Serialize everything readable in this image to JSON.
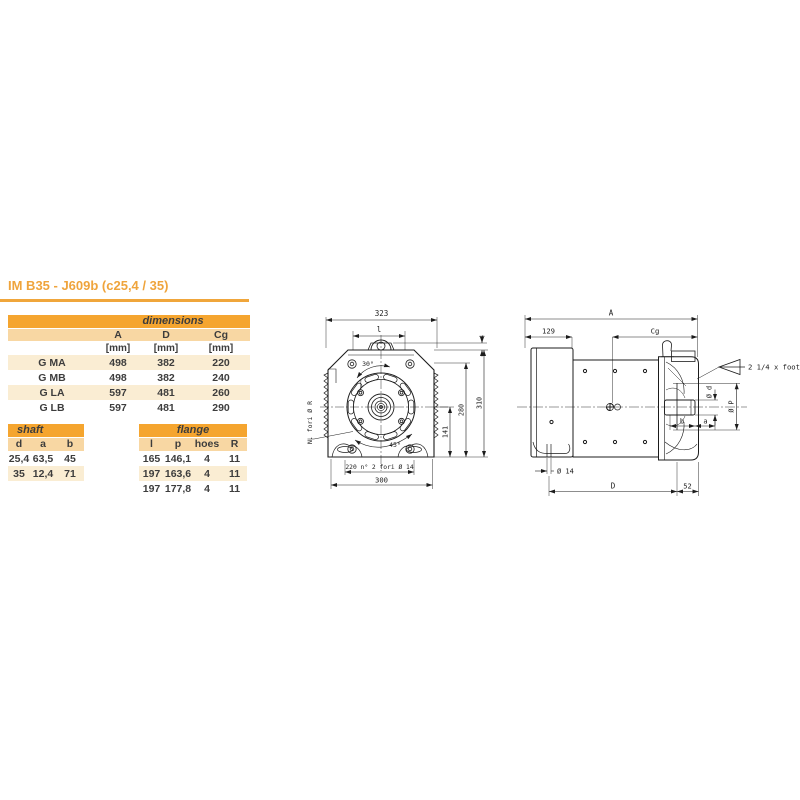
{
  "title": "IM B35 - J609b (c25,4 / 35)",
  "colors": {
    "accent_orange": "#F0A63B",
    "table_header_bg": "#F5A52F",
    "table_subheader_bg": "#F8D7A3",
    "table_alt_row_bg": "#FAEDD3",
    "table_text": "#3d3d3d",
    "drawing_line": "#1c1c1c"
  },
  "dimensions_table": {
    "header": "dimensions",
    "columns": [
      "A",
      "D",
      "Cg"
    ],
    "units": [
      "[mm]",
      "[mm]",
      "[mm]"
    ],
    "rows": [
      {
        "label": "G MA",
        "values": [
          "498",
          "382",
          "220"
        ]
      },
      {
        "label": "G MB",
        "values": [
          "498",
          "382",
          "240"
        ]
      },
      {
        "label": "G LA",
        "values": [
          "597",
          "481",
          "260"
        ]
      },
      {
        "label": "G LB",
        "values": [
          "597",
          "481",
          "290"
        ]
      }
    ]
  },
  "shaft_table": {
    "header": "shaft",
    "columns": [
      "d",
      "a",
      "b"
    ],
    "rows": [
      [
        "25,4",
        "63,5",
        "45"
      ],
      [
        "35",
        "12,4",
        "71"
      ]
    ]
  },
  "flange_table": {
    "header": "flange",
    "columns": [
      "l",
      "p",
      "hoes",
      "R"
    ],
    "rows": [
      [
        "165",
        "146,1",
        "4",
        "11"
      ],
      [
        "197",
        "163,6",
        "4",
        "11"
      ],
      [
        "197",
        "177,8",
        "4",
        "11"
      ]
    ]
  },
  "front_view": {
    "dim_overall_width": "323",
    "dim_inner_width": "l",
    "dim_plate_thickness": "4",
    "angle_upper": "30°",
    "angle_lower": "45°",
    "holes_note": "N. fori Ø R",
    "dim_shaft_height": "141",
    "dim_height_280": "280",
    "dim_height_310": "310",
    "feet_holes_note": "220 n° 2 fori Ø 14",
    "dim_feet_width": "300"
  },
  "side_view": {
    "dim_overall_length": "A",
    "dim_adapter_length": "129",
    "dim_cg": "Cg",
    "foot_note": "2 1/4 x foot",
    "dim_shaft_diameter": "Ø d",
    "dim_pilot_diameter": "Ø P",
    "dim_b": "b",
    "dim_a": "a",
    "dim_foot_hole": "Ø 14",
    "dim_d_length": "D",
    "dim_52": "52"
  }
}
